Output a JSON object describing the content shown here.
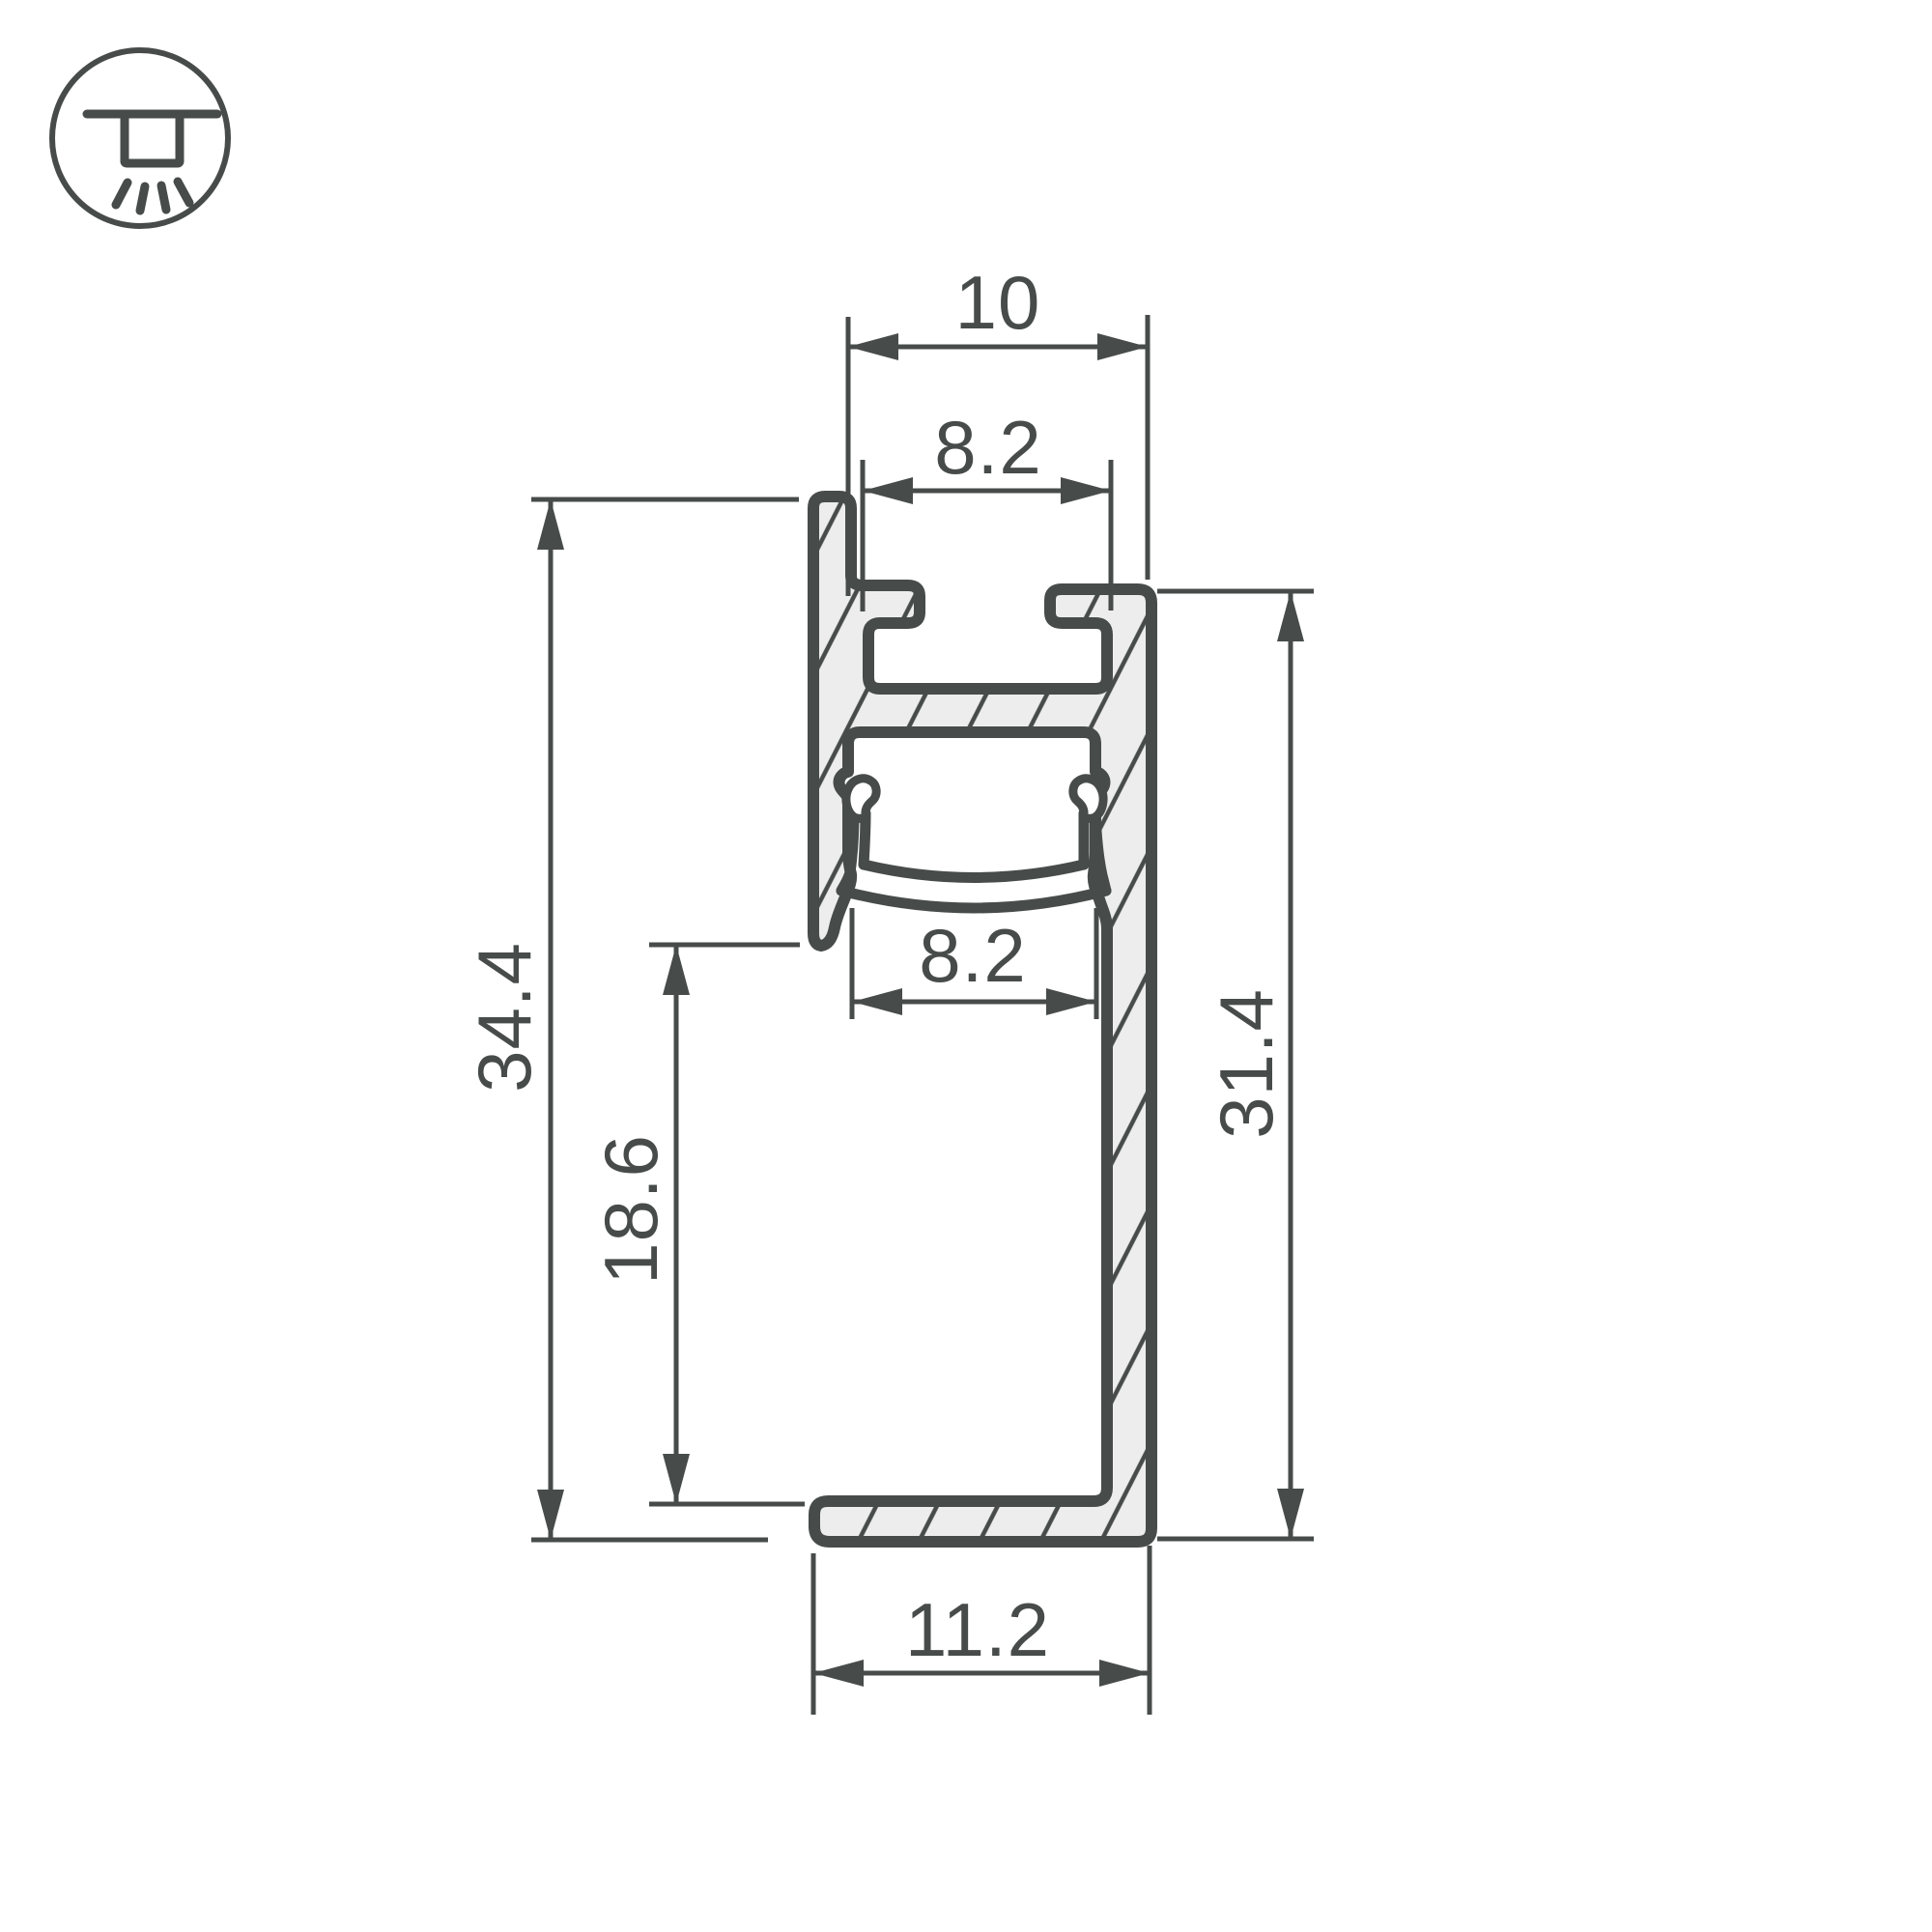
{
  "drawing": {
    "title": "led-profile-cross-section-technical-drawing",
    "icon": "recessed-ceiling-light-icon",
    "colors": {
      "line": "#474C4A",
      "aluminum_fill": "#EDEDEE",
      "background": "#FFFFFF"
    },
    "dimensions": {
      "top_outer_width": "10",
      "top_slot_width": "8.2",
      "led_slot_width": "8.2",
      "overall_height": "34.4",
      "left_leg_height": "18.6",
      "right_wall_height": "31.4",
      "base_width": "11.2"
    }
  }
}
